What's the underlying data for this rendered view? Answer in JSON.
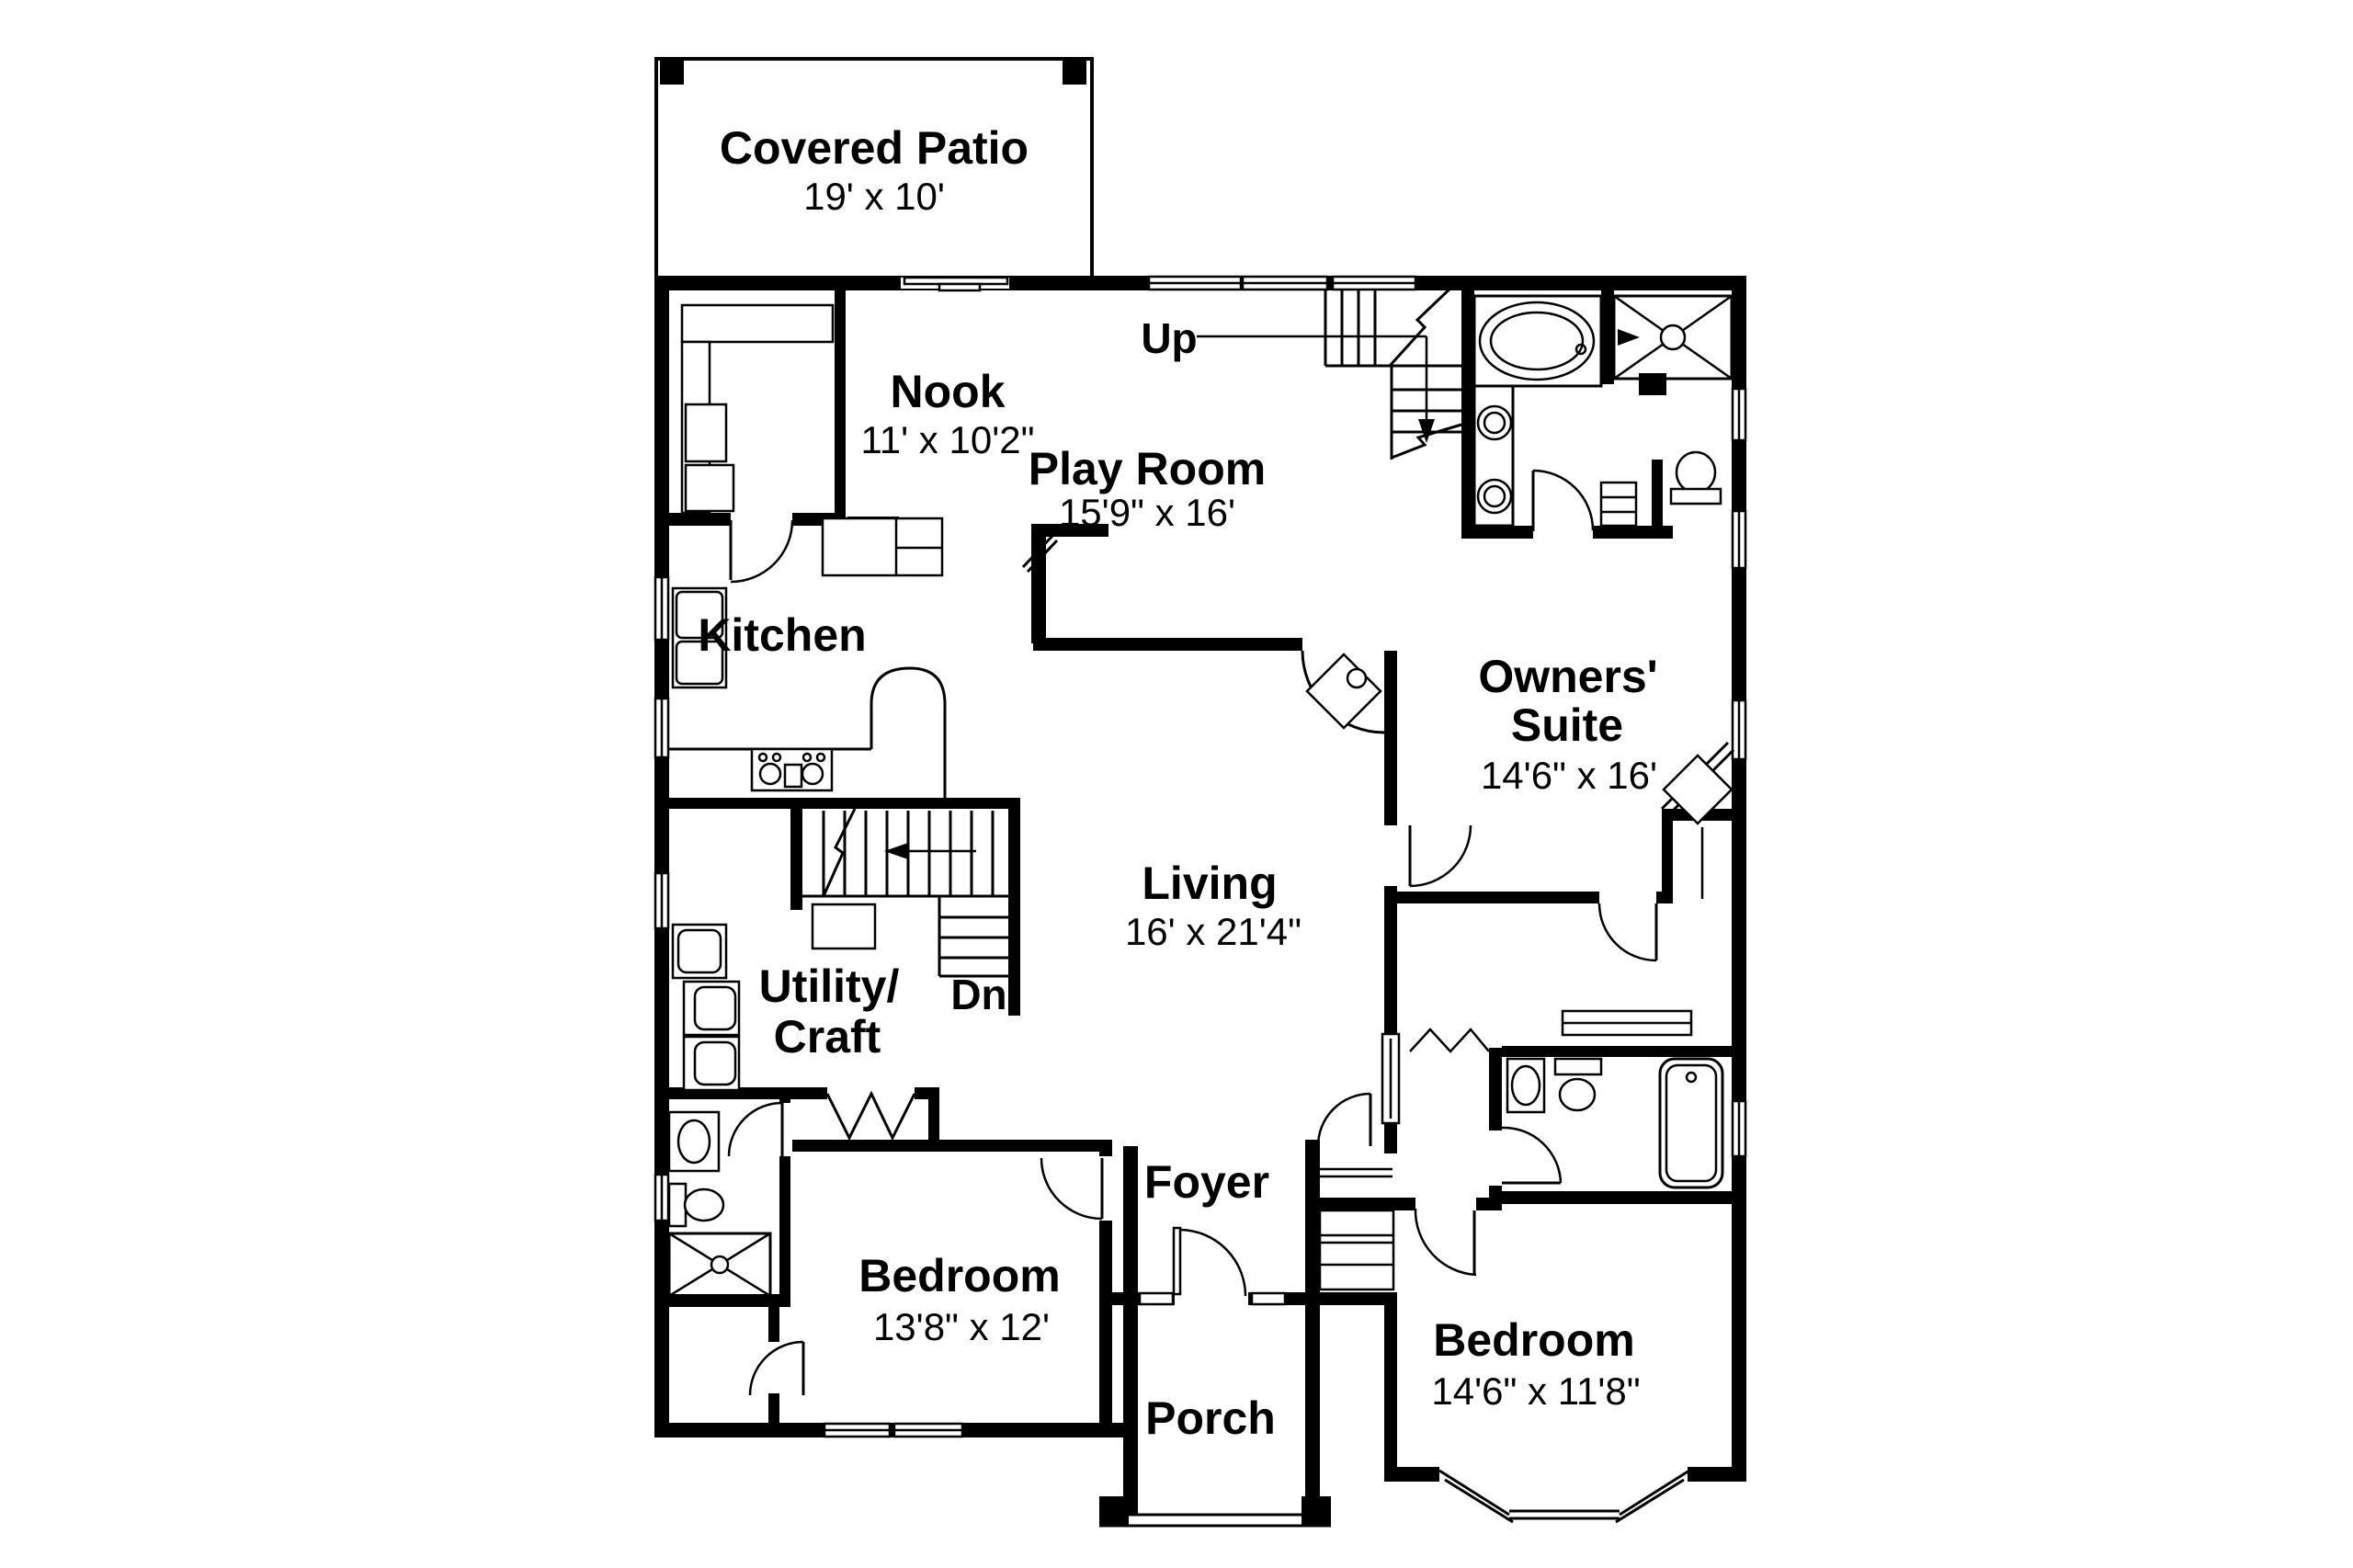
{
  "plan": {
    "covered_patio": {
      "name": "Covered Patio",
      "dims": "19' x 10'"
    },
    "nook": {
      "name": "Nook",
      "dims": "11' x 10'2\""
    },
    "play_room": {
      "name": "Play Room",
      "dims": "15'9\" x 16'"
    },
    "kitchen": {
      "name": "Kitchen"
    },
    "owners_suite": {
      "name_line1": "Owners'",
      "name_line2": "Suite",
      "dims": "14'6\" x 16'"
    },
    "living": {
      "name": "Living",
      "dims": "16' x 21'4\""
    },
    "utility": {
      "name_line1": "Utility/",
      "name_line2": "Craft"
    },
    "foyer": {
      "name": "Foyer"
    },
    "porch": {
      "name": "Porch"
    },
    "bedroom_left": {
      "name": "Bedroom",
      "dims": "13'8\" x 12'"
    },
    "bedroom_right": {
      "name": "Bedroom",
      "dims": "14'6\" x 11'8\""
    },
    "stairs": {
      "up": "Up",
      "down": "Dn"
    }
  },
  "colors": {
    "ink": "#000000",
    "paper": "#ffffff"
  }
}
